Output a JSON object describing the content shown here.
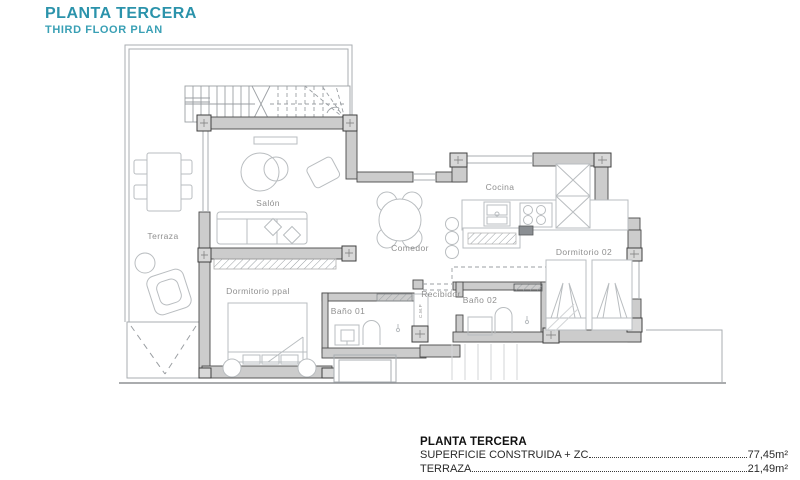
{
  "header": {
    "title": "PLANTA TERCERA",
    "subtitle": "THIRD FLOOR PLAN"
  },
  "plan": {
    "rooms": {
      "terraza": "Terraza",
      "salon": "Salón",
      "comedor": "Comedor",
      "cocina": "Cocina",
      "dormitorio_ppal": "Dormitorio ppal",
      "dormitorio_02": "Dormitorio 02",
      "bano_01": "Baño 01",
      "bano_02": "Baño 02",
      "recibidor": "Recibidor",
      "cmp": "C.M.P"
    }
  },
  "legend": {
    "title": "PLANTA TERCERA",
    "rows": [
      {
        "label": "SUPERFICIE CONSTRUIDA + ZC",
        "value": "77,45m²"
      },
      {
        "label": "TERRAZA",
        "value": "21,49m²"
      }
    ]
  },
  "colors": {
    "accent_title": "#2b93ab",
    "accent_subtitle": "#3aa0b5",
    "wall_fill": "#cccccc",
    "wall_stroke": "#4a4a4a",
    "furniture_line": "#b9bdc0",
    "room_label": "#8f8f8f",
    "legend_text": "#222222"
  }
}
